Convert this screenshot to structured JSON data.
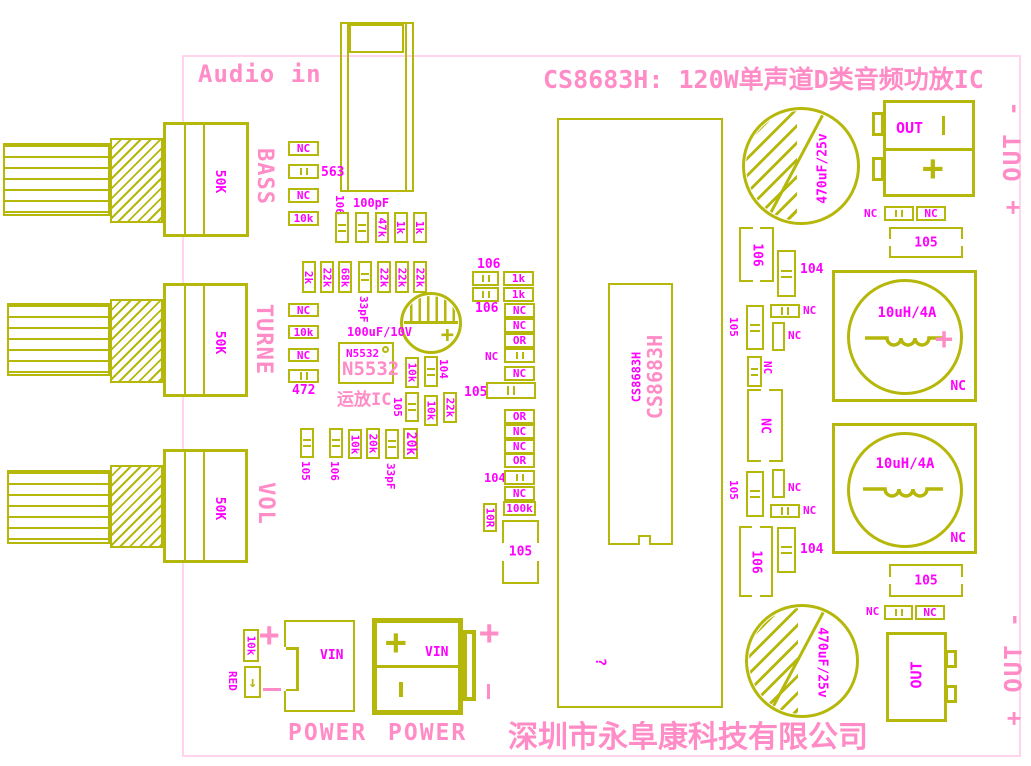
{
  "colors": {
    "silkscreen_yellow": "#b5b80a",
    "label_magenta": "#ff00ff",
    "text_pink": "#ff8cc6",
    "board_outline": "#ffd4ec"
  },
  "title": "CS8683H: 120W单声道D类音频功放IC",
  "audio_in_label": "Audio in",
  "company": "深圳市永阜康科技有限公司",
  "signs": {
    "plus": "+",
    "minus": "-"
  },
  "pots": [
    {
      "label": "BASS",
      "value": "50K"
    },
    {
      "label": "TURNE",
      "value": "50K"
    },
    {
      "label": "VOL",
      "value": "50K"
    }
  ],
  "opamp": {
    "ref_small": "N5532",
    "ref_big": "N5532",
    "caption": "运放IC",
    "cap_label": "100uF/10V"
  },
  "ic": {
    "ref_small": "CS8683H",
    "ref_big": "CS8683H",
    "mark": "?"
  },
  "inductors": [
    {
      "value": "10uH/4A",
      "corner": "NC"
    },
    {
      "value": "10uH/4A",
      "corner": "NC"
    }
  ],
  "big_caps": [
    {
      "value": "470uF/25v"
    },
    {
      "value": "470uF/25v"
    }
  ],
  "out_top": {
    "label": "OUT",
    "side": "+ OUT -"
  },
  "out_bottom": {
    "label": "OUT",
    "side": "+ OUT -"
  },
  "power_jack": {
    "label": "VIN",
    "caption": "POWER"
  },
  "power_terminal": {
    "label": "VIN",
    "caption": "POWER"
  },
  "led": {
    "label": "RED",
    "arrow": "↓"
  },
  "components": [
    {
      "t": "hbox",
      "x": 288,
      "y": 141,
      "w": 31,
      "h": 15,
      "label": "NC"
    },
    {
      "t": "hcap",
      "x": 288,
      "y": 164,
      "w": 31,
      "h": 15
    },
    {
      "t": "lab",
      "x": 321,
      "y": 166,
      "label": "563",
      "fs": 13
    },
    {
      "t": "hbox",
      "x": 288,
      "y": 188,
      "w": 31,
      "h": 15,
      "label": "NC"
    },
    {
      "t": "hbox",
      "x": 288,
      "y": 211,
      "w": 31,
      "h": 15,
      "label": "10k"
    },
    {
      "t": "vlab",
      "x": 345,
      "y": 195,
      "label": "106"
    },
    {
      "t": "lab",
      "x": 353,
      "y": 197,
      "label": "100pF",
      "fs": 12
    },
    {
      "t": "vcap",
      "x": 335,
      "y": 212,
      "w": 14,
      "h": 31
    },
    {
      "t": "vcap",
      "x": 355,
      "y": 212,
      "w": 14,
      "h": 31
    },
    {
      "t": "vbox",
      "x": 375,
      "y": 212,
      "w": 14,
      "h": 31,
      "label": "47k"
    },
    {
      "t": "vbox",
      "x": 394,
      "y": 212,
      "w": 14,
      "h": 31,
      "label": "1k"
    },
    {
      "t": "vbox",
      "x": 413,
      "y": 212,
      "w": 14,
      "h": 31,
      "label": "1k"
    },
    {
      "t": "vbox",
      "x": 302,
      "y": 261,
      "w": 14,
      "h": 32,
      "label": "2k"
    },
    {
      "t": "vbox",
      "x": 320,
      "y": 261,
      "w": 14,
      "h": 32,
      "label": "22k"
    },
    {
      "t": "vbox",
      "x": 338,
      "y": 261,
      "w": 14,
      "h": 32,
      "label": "68k"
    },
    {
      "t": "vcap",
      "x": 358,
      "y": 261,
      "w": 14,
      "h": 32
    },
    {
      "t": "vlab",
      "x": 369,
      "y": 296,
      "label": "33pF"
    },
    {
      "t": "vbox",
      "x": 377,
      "y": 261,
      "w": 14,
      "h": 32,
      "label": "22k"
    },
    {
      "t": "vbox",
      "x": 395,
      "y": 261,
      "w": 14,
      "h": 32,
      "label": "22k"
    },
    {
      "t": "vbox",
      "x": 413,
      "y": 261,
      "w": 14,
      "h": 32,
      "label": "22k"
    },
    {
      "t": "hbox",
      "x": 288,
      "y": 303,
      "w": 31,
      "h": 14,
      "label": "NC"
    },
    {
      "t": "hbox",
      "x": 288,
      "y": 325,
      "w": 31,
      "h": 14,
      "label": "10k"
    },
    {
      "t": "hbox",
      "x": 288,
      "y": 348,
      "w": 31,
      "h": 14,
      "label": "NC"
    },
    {
      "t": "hcap",
      "x": 288,
      "y": 369,
      "w": 31,
      "h": 14
    },
    {
      "t": "lab",
      "x": 292,
      "y": 384,
      "label": "472",
      "fs": 13
    },
    {
      "t": "lab",
      "x": 347,
      "y": 326,
      "label": "100uF/10V",
      "fs": 12
    },
    {
      "t": "vbox",
      "x": 405,
      "y": 357,
      "w": 14,
      "h": 31,
      "label": "10k"
    },
    {
      "t": "vcap",
      "x": 424,
      "y": 356,
      "w": 14,
      "h": 31
    },
    {
      "t": "vlab",
      "x": 449,
      "y": 359,
      "label": "104"
    },
    {
      "t": "vlab",
      "x": 403,
      "y": 397,
      "label": "105"
    },
    {
      "t": "vcap",
      "x": 405,
      "y": 392,
      "w": 14,
      "h": 30
    },
    {
      "t": "vbox",
      "x": 424,
      "y": 395,
      "w": 14,
      "h": 31,
      "label": "10k"
    },
    {
      "t": "vbox",
      "x": 443,
      "y": 392,
      "w": 14,
      "h": 31,
      "label": "22k"
    },
    {
      "t": "vcap",
      "x": 300,
      "y": 428,
      "w": 14,
      "h": 30
    },
    {
      "t": "vlab",
      "x": 311,
      "y": 461,
      "label": "105"
    },
    {
      "t": "vcap",
      "x": 329,
      "y": 428,
      "w": 14,
      "h": 30
    },
    {
      "t": "vlab",
      "x": 340,
      "y": 461,
      "label": "106"
    },
    {
      "t": "vbox",
      "x": 348,
      "y": 429,
      "w": 14,
      "h": 30,
      "label": "10k"
    },
    {
      "t": "vbox",
      "x": 366,
      "y": 428,
      "w": 14,
      "h": 31,
      "label": "20k"
    },
    {
      "t": "vcap",
      "x": 385,
      "y": 429,
      "w": 14,
      "h": 30
    },
    {
      "t": "vlab",
      "x": 396,
      "y": 463,
      "label": "33pF"
    },
    {
      "t": "vbox",
      "x": 403,
      "y": 428,
      "w": 15,
      "h": 31,
      "label": "20k",
      "fs": 13
    },
    {
      "t": "lab",
      "x": 477,
      "y": 258,
      "label": "106",
      "fs": 13
    },
    {
      "t": "hcap",
      "x": 472,
      "y": 271,
      "w": 27,
      "h": 15
    },
    {
      "t": "hbox",
      "x": 503,
      "y": 271,
      "w": 31,
      "h": 15,
      "label": "1k"
    },
    {
      "t": "hcap",
      "x": 472,
      "y": 287,
      "w": 27,
      "h": 15
    },
    {
      "t": "hbox",
      "x": 503,
      "y": 287,
      "w": 31,
      "h": 15,
      "label": "1k"
    },
    {
      "t": "lab",
      "x": 475,
      "y": 302,
      "label": "106",
      "fs": 13
    },
    {
      "t": "hbox",
      "x": 504,
      "y": 303,
      "w": 31,
      "h": 15,
      "label": "NC"
    },
    {
      "t": "hbox",
      "x": 504,
      "y": 318,
      "w": 31,
      "h": 15,
      "label": "NC"
    },
    {
      "t": "hbox",
      "x": 504,
      "y": 333,
      "w": 31,
      "h": 15,
      "label": "OR"
    },
    {
      "t": "lab",
      "x": 485,
      "y": 351,
      "label": "NC"
    },
    {
      "t": "hcap",
      "x": 504,
      "y": 348,
      "w": 31,
      "h": 15
    },
    {
      "t": "hbox",
      "x": 504,
      "y": 366,
      "w": 31,
      "h": 15,
      "label": "NC"
    },
    {
      "t": "lab",
      "x": 464,
      "y": 386,
      "label": "105",
      "fs": 13
    },
    {
      "t": "hcap",
      "x": 486,
      "y": 382,
      "w": 50,
      "h": 17
    },
    {
      "t": "hbox",
      "x": 504,
      "y": 409,
      "w": 31,
      "h": 15,
      "label": "OR"
    },
    {
      "t": "hbox",
      "x": 504,
      "y": 424,
      "w": 31,
      "h": 15,
      "label": "NC"
    },
    {
      "t": "hbox",
      "x": 504,
      "y": 439,
      "w": 31,
      "h": 15,
      "label": "NC"
    },
    {
      "t": "hbox",
      "x": 504,
      "y": 453,
      "w": 31,
      "h": 15,
      "label": "OR"
    },
    {
      "t": "lab",
      "x": 484,
      "y": 472,
      "label": "104",
      "fs": 12
    },
    {
      "t": "hcap",
      "x": 504,
      "y": 470,
      "w": 31,
      "h": 15
    },
    {
      "t": "hbox",
      "x": 504,
      "y": 486,
      "w": 31,
      "h": 15,
      "label": "NC"
    },
    {
      "t": "hbox",
      "x": 503,
      "y": 501,
      "w": 33,
      "h": 15,
      "label": "100k"
    },
    {
      "t": "vbox",
      "x": 483,
      "y": 503,
      "w": 14,
      "h": 29,
      "label": "10R"
    },
    {
      "t": "fch",
      "x": 502,
      "y": 520,
      "w": 37,
      "h": 64,
      "label": "105"
    },
    {
      "t": "fcv",
      "x": 739,
      "y": 227,
      "w": 35,
      "h": 55,
      "label": "106"
    },
    {
      "t": "vcap",
      "x": 777,
      "y": 250,
      "w": 19,
      "h": 47
    },
    {
      "t": "lab",
      "x": 800,
      "y": 263,
      "label": "104",
      "fs": 13
    },
    {
      "t": "vlab",
      "x": 739,
      "y": 317,
      "label": "105"
    },
    {
      "t": "vcap",
      "x": 746,
      "y": 305,
      "w": 18,
      "h": 45
    },
    {
      "t": "hcap",
      "x": 770,
      "y": 304,
      "w": 30,
      "h": 14
    },
    {
      "t": "lab",
      "x": 803,
      "y": 305,
      "label": "NC"
    },
    {
      "t": "vrect",
      "x": 772,
      "y": 322,
      "w": 13,
      "h": 29
    },
    {
      "t": "lab",
      "x": 788,
      "y": 330,
      "label": "NC"
    },
    {
      "t": "vcap",
      "x": 747,
      "y": 356,
      "w": 15,
      "h": 31
    },
    {
      "t": "vlab",
      "x": 773,
      "y": 361,
      "label": "NC"
    },
    {
      "t": "fcv",
      "x": 747,
      "y": 389,
      "w": 36,
      "h": 73,
      "label": "NC"
    },
    {
      "t": "fch",
      "x": 889,
      "y": 227,
      "w": 74,
      "h": 31,
      "label": "105"
    },
    {
      "t": "lab",
      "x": 864,
      "y": 208,
      "label": "NC"
    },
    {
      "t": "hcap",
      "x": 884,
      "y": 206,
      "w": 30,
      "h": 15
    },
    {
      "t": "hbox",
      "x": 916,
      "y": 206,
      "w": 30,
      "h": 15,
      "label": "NC"
    },
    {
      "t": "vcap",
      "x": 746,
      "y": 471,
      "w": 18,
      "h": 46
    },
    {
      "t": "vlab",
      "x": 739,
      "y": 480,
      "label": "105"
    },
    {
      "t": "vrect",
      "x": 772,
      "y": 469,
      "w": 13,
      "h": 29
    },
    {
      "t": "lab",
      "x": 788,
      "y": 482,
      "label": "NC"
    },
    {
      "t": "hcap",
      "x": 770,
      "y": 504,
      "w": 30,
      "h": 14
    },
    {
      "t": "lab",
      "x": 803,
      "y": 505,
      "label": "NC"
    },
    {
      "t": "fcv",
      "x": 739,
      "y": 526,
      "w": 34,
      "h": 71,
      "label": "106"
    },
    {
      "t": "vcap",
      "x": 777,
      "y": 527,
      "w": 19,
      "h": 46
    },
    {
      "t": "lab",
      "x": 800,
      "y": 543,
      "label": "104",
      "fs": 13
    },
    {
      "t": "fch",
      "x": 889,
      "y": 564,
      "w": 74,
      "h": 33,
      "label": "105"
    },
    {
      "t": "lab",
      "x": 866,
      "y": 606,
      "label": "NC"
    },
    {
      "t": "hcap",
      "x": 884,
      "y": 605,
      "w": 29,
      "h": 15
    },
    {
      "t": "hbox",
      "x": 915,
      "y": 605,
      "w": 30,
      "h": 15,
      "label": "NC"
    },
    {
      "t": "vbox",
      "x": 243,
      "y": 629,
      "w": 16,
      "h": 33,
      "label": "10k"
    },
    {
      "t": "vlab",
      "x": 238,
      "y": 671,
      "label": "RED"
    }
  ]
}
